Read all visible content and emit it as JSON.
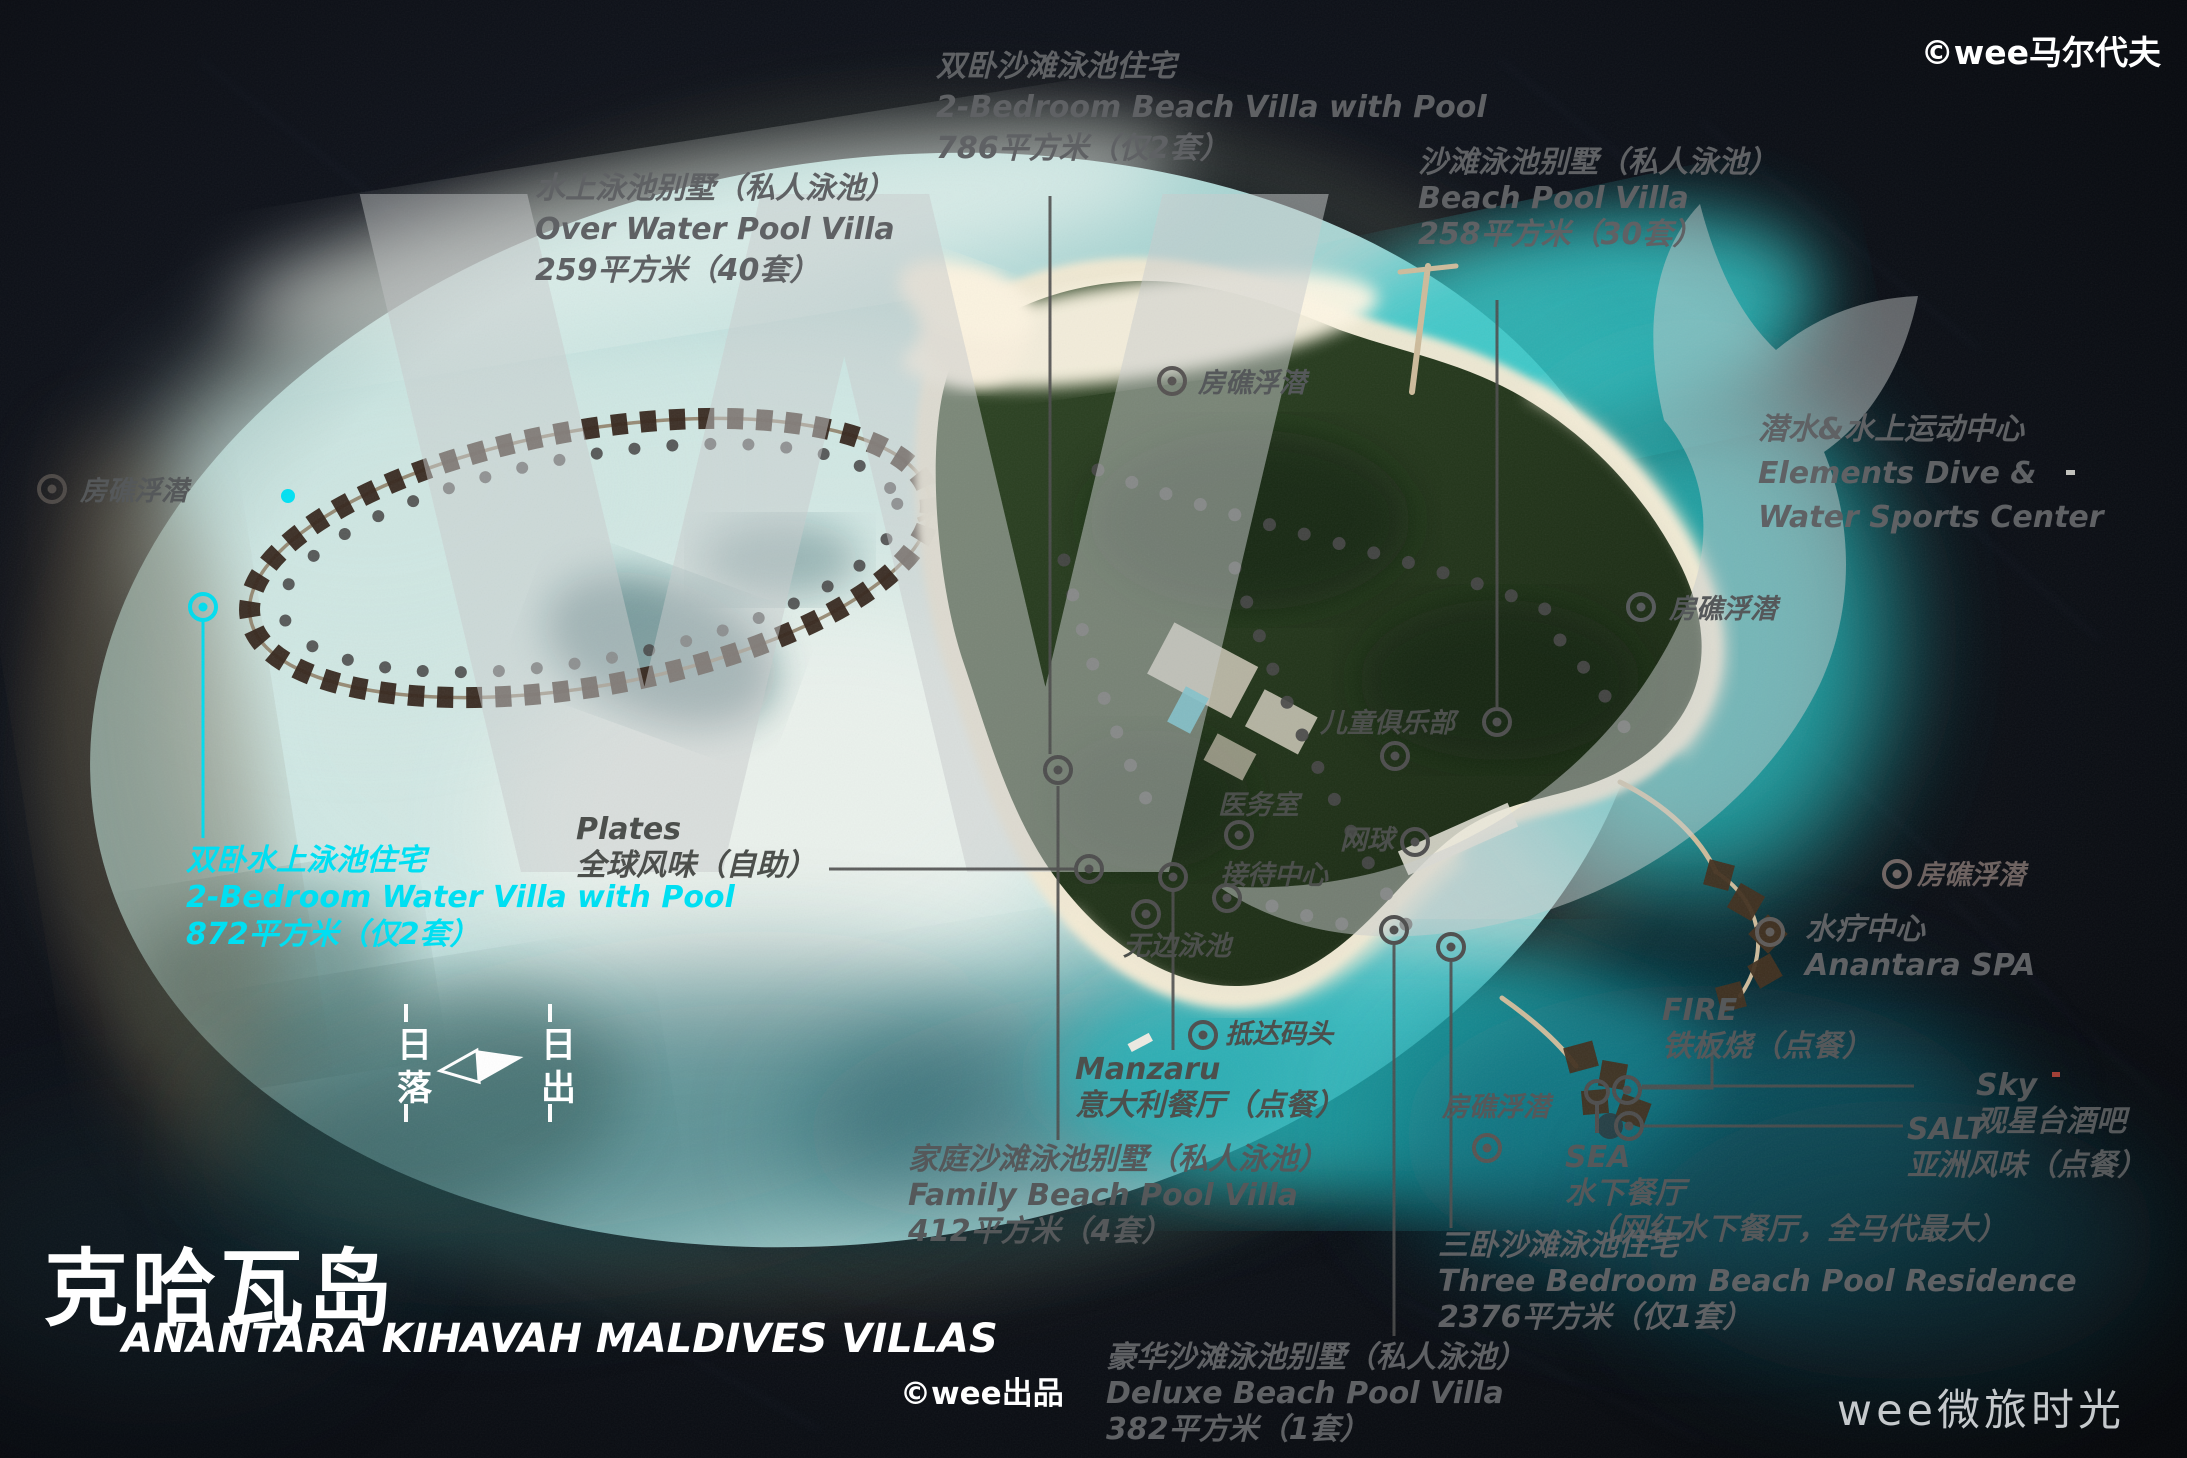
{
  "branding": {
    "island_cn": "克哈瓦岛",
    "island_en": "ANANTARA KIHAVAH MALDIVES VILLAS",
    "credit": "©wee出品",
    "watermark_top_right": "©wee马尔代夫",
    "watermark_bottom_right": "wee微旅时光",
    "logo_letter": "W"
  },
  "colors": {
    "accent_cyan": "#00dff2",
    "label_gray": "#565656",
    "white": "#ffffff"
  },
  "compass": {
    "sunset": "日落",
    "sunrise": "日出"
  },
  "villas": {
    "over_water": {
      "l1": "水上泳池别墅（私人泳池）",
      "l2": "Over Water Pool Villa",
      "l3": "259平方米（40套）"
    },
    "beach_2br": {
      "l1": "双卧沙滩泳池住宅",
      "l2": "2-Bedroom Beach Villa with Pool",
      "l3": "786平方米（仅2套）"
    },
    "beach_pool": {
      "l1": "沙滩泳池别墅（私人泳池）",
      "l2": "Beach Pool Villa",
      "l3": "258平方米（30套）"
    },
    "water_2br": {
      "l1": "双卧水上泳池住宅",
      "l2": "2-Bedroom Water Villa with Pool",
      "l3": "872平方米（仅2套）"
    },
    "family": {
      "l1": "家庭沙滩泳池别墅（私人泳池）",
      "l2": "Family Beach Pool Villa",
      "l3": "412平方米（4套）"
    },
    "three_bedroom": {
      "l1": "三卧沙滩泳池住宅",
      "l2": "Three Bedroom Beach Pool Residence",
      "l3": "2376平方米（仅1套）"
    },
    "deluxe": {
      "l1": "豪华沙滩泳池别墅（私人泳池）",
      "l2": "Deluxe Beach Pool Villa",
      "l3": "382平方米（1套）"
    }
  },
  "facilities": {
    "dive_center": {
      "l1": "潜水&水上运动中心",
      "l2": "Elements Dive &",
      "l3": "Water Sports Center"
    },
    "plates": {
      "l1": "Plates",
      "l2": "全球风味（自助）"
    },
    "manzaru": {
      "l1": "Manzaru",
      "l2": "意大利餐厅（点餐）"
    },
    "fire": {
      "l1": "FIRE",
      "l2": "铁板烧（点餐）"
    },
    "sky": {
      "l1": "Sky",
      "l2": "观星台酒吧"
    },
    "salt": {
      "l1": "SALT",
      "l2": "亚洲风味（点餐）"
    },
    "sea": {
      "l1": "SEA",
      "l2": "水下餐厅",
      "l3": "（网红水下餐厅，全马代最大）"
    },
    "spa": {
      "l1": "水疗中心",
      "l2": "Anantara SPA"
    },
    "kids_club": "儿童俱乐部",
    "clinic": "医务室",
    "tennis": "网球",
    "reception": "接待中心",
    "infinity_pool": "无边泳池",
    "arrival_jetty": "抵达码头",
    "house_reef": "房礁浮潜"
  }
}
